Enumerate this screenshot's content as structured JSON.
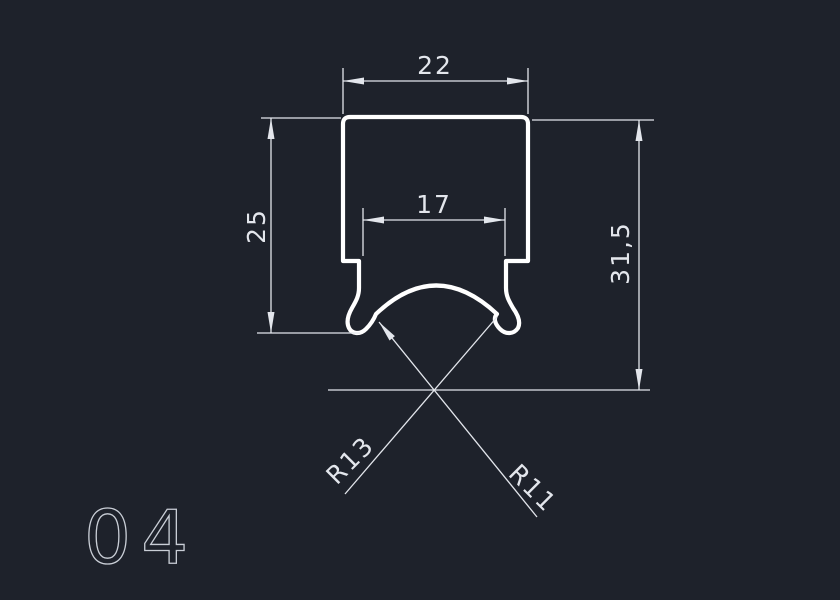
{
  "canvas": {
    "colors": {
      "background": "#1e222b",
      "profile_line": "#ffffff",
      "dimension_line": "#e3e6ec",
      "drawing_number": "#c9ced6"
    }
  },
  "drawing_number": "04",
  "dimensions": {
    "top_width": "22",
    "inner_width": "17",
    "left_height": "25",
    "total_height": "31,5",
    "radius_outer": "R13",
    "radius_inner": "R11"
  }
}
